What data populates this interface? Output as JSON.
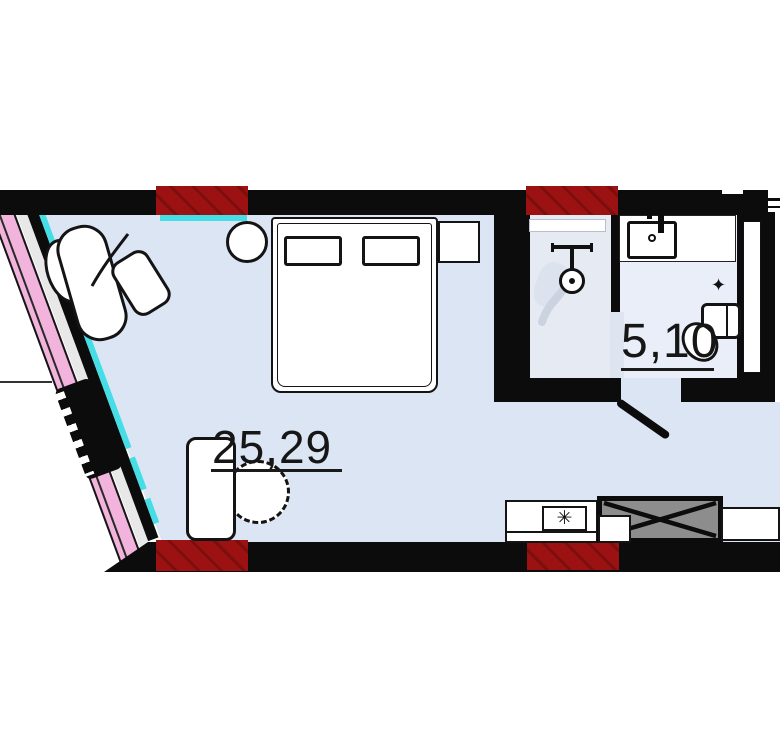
{
  "page": {
    "type": "apartment-floor-plan"
  },
  "labels": {
    "main_room_area": "25,29",
    "bathroom_area": "5,10"
  },
  "glyphs": {
    "stove_burner": "✳",
    "valve": "✦"
  },
  "colors": {
    "wall_black": "#0c0c0c",
    "window_cyan": "#45dde6",
    "masonry_red": "#9c1212",
    "adjacent_structure_pink": "#f2b3dc",
    "room_fill_blue": "#dce5f3",
    "bathroom_fill": "#e9eef8",
    "appliance_gray": "#8d8d8d"
  }
}
